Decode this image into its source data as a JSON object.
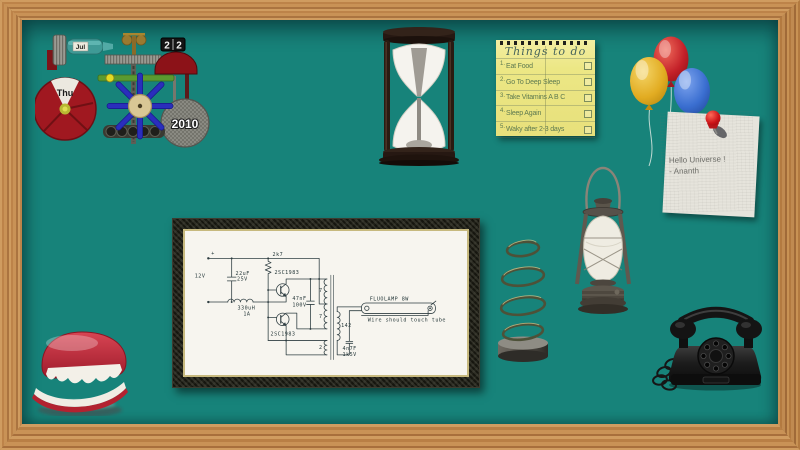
{
  "colors": {
    "board": "#17837a",
    "frame_wood": "#c28a50",
    "note_yellow": "#ece785",
    "paper_white": "#f2f0ea",
    "balloon_yellow": "#e7b52f",
    "balloon_red": "#c5242c",
    "balloon_blue": "#3a6ed0",
    "teeth_red": "#c22f3e",
    "circuit_ink": "#26383a"
  },
  "calendar": {
    "month": "Jul",
    "date_left": "2",
    "date_right": "2",
    "day": "Thu",
    "year": "2010"
  },
  "todo": {
    "title": "Things to do",
    "items": [
      {
        "num": "1.",
        "text": "Eat Food"
      },
      {
        "num": "2.",
        "text": "Go To Deep Sleep"
      },
      {
        "num": "3.",
        "text": "Take Vitamins A B C"
      },
      {
        "num": "4.",
        "text": "Sleep Again"
      },
      {
        "num": "5.",
        "text": "Waky after 2-3 days"
      }
    ]
  },
  "note": {
    "line1": "Hello Universe !",
    "line2": "- Ananth"
  },
  "circuit": {
    "supply": "12V",
    "polarity": "+",
    "cap1_value": "22uF",
    "cap1_rating": "25V",
    "inductor_value": "330uH",
    "inductor_rating": "1A",
    "resistor": "2k7",
    "transistor_top": "2SC1983",
    "transistor_bottom": "2SC1983",
    "cap2_value": "47nF",
    "cap2_rating": "100V",
    "winding_top": "7",
    "winding_mid": "7",
    "winding_feedback": "2",
    "winding_secondary": "142",
    "cap3_value": "4n7F",
    "cap3_rating": "1k5V",
    "lamp_label": "FLUOLAMP 8W",
    "lamp_note": "Wire should touch tube"
  }
}
